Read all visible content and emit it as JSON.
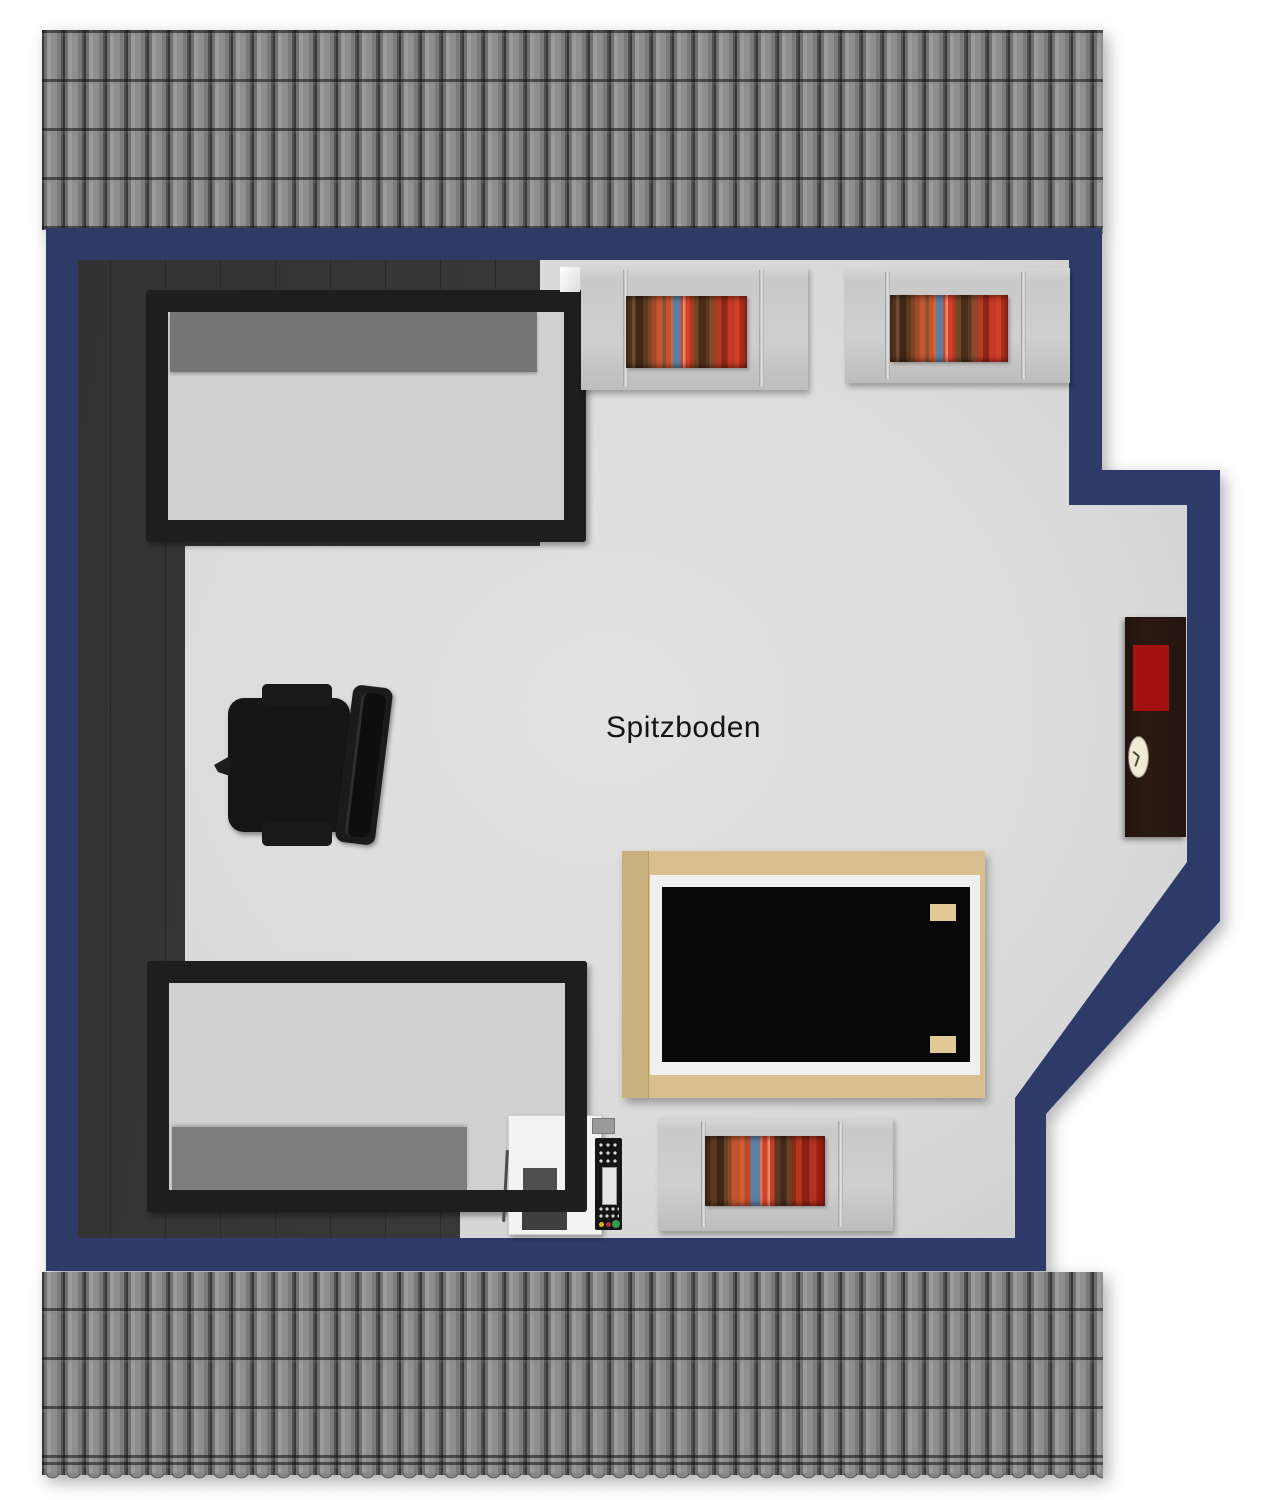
{
  "room": {
    "label": "Spitzboden",
    "type": "attic floor plan, top-down 3D render",
    "wall_color": "#2e3a68",
    "floor_color": "#dcdcdc",
    "dark_floor_color": "#333333",
    "roof_tile_color": "#8a8a8a",
    "background_color": "#ffffff"
  },
  "furniture": {
    "beds": [
      {
        "name": "single bed top-left",
        "frame_color": "#1e1e1e",
        "mattress_color": "#d0d0d0",
        "duvet_color": "#767676",
        "duvet_position": "head end (top)"
      },
      {
        "name": "single bed bottom-left",
        "frame_color": "#1e1e1e",
        "mattress_color": "#d0d0d0",
        "duvet_color": "#7d7d7d",
        "duvet_position": "foot end (bottom)"
      }
    ],
    "bookshelves": [
      {
        "name": "bookshelf top-left wall",
        "shelf_color": "#cccccc"
      },
      {
        "name": "bookshelf top-right wall",
        "shelf_color": "#cccccc"
      },
      {
        "name": "bookshelf bottom wall",
        "shelf_color": "#cccccc"
      }
    ],
    "book_colors": [
      "#53331e",
      "#a54a28",
      "#c2572e",
      "#5b80a6",
      "#d14028",
      "#8e2518"
    ],
    "office_chair": {
      "name": "black office chair",
      "color": "#161616"
    },
    "table": {
      "name": "table with black top",
      "frame_color": "#d8bf8d",
      "top_color": "#0a0a0a",
      "border_color": "#f0f0f0",
      "cushion_color": "#e2ca96"
    },
    "cabinet": {
      "name": "wall cabinet",
      "body_color": "#271811",
      "tray_color": "#a31111",
      "clock_color": "#ece2cc"
    },
    "printer": {
      "name": "printer-copier",
      "body_color": "#f3f3f3",
      "panel_color": "#151515",
      "button_colors": [
        "#d8b020",
        "#c03020",
        "#2e9e4f"
      ]
    },
    "white_box": {
      "name": "small white object",
      "color": "#ffffff"
    }
  }
}
